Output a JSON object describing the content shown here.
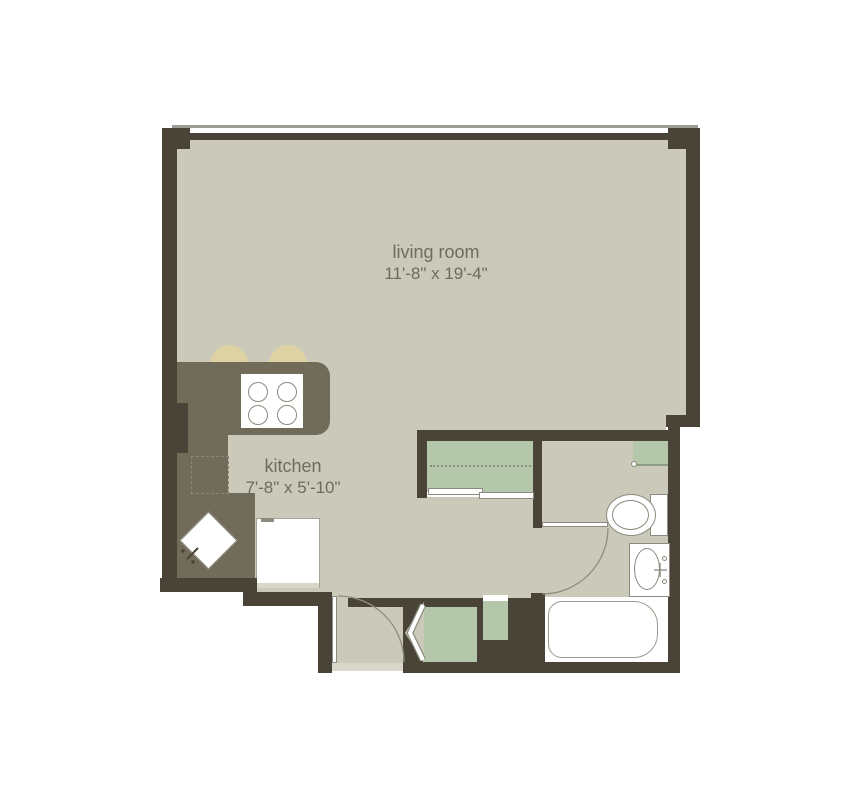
{
  "title": "studio apartment floor plan",
  "rooms": {
    "living": {
      "name": "living room",
      "dims": "11'-8\" x 19'-4\""
    },
    "kitchen": {
      "name": "kitchen",
      "dims": "7'-8\" x 5'-10\""
    },
    "bathroom": {
      "name": "",
      "dims": ""
    }
  },
  "fixtures": [
    "window-band",
    "breakfast-bar-stools",
    "kitchen-counter",
    "stove-cooktop",
    "dishwasher",
    "corner-sink",
    "refrigerator",
    "sliding-door-closet",
    "bifold-closet",
    "utility-closet",
    "entry-door",
    "bathroom-door",
    "toilet",
    "vanity-sink",
    "bathtub",
    "bathroom-shelf"
  ],
  "palette": {
    "wall": "#4a4438",
    "counter": "#716c59",
    "floor": "#cac9ba",
    "green": "#b5c7aa",
    "beige": "#ded2a2",
    "white": "#ffffff",
    "line": "#8b8b7f",
    "lightline": "#9c9c92",
    "threshold": "#d8d7c9",
    "text": "#6c6c5f"
  }
}
